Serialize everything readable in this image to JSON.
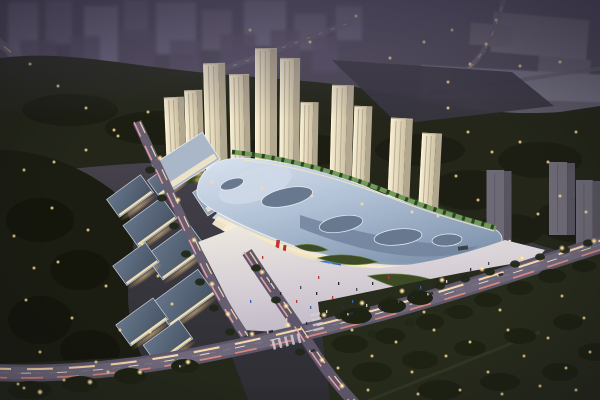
{
  "scene": {
    "type": "aerial-architectural-rendering",
    "time_of_day": "dusk",
    "subject": "mixed-use development: curved-roof shopping mall with front plaza, low-rise retail street, arc of lit residential towers, road intersection with light trails, surrounding parks and distant city",
    "landmarks": {
      "shopping_mall": "organic curved silver-blue roof with oval skylights and rooftop green walkway",
      "retail_street": "low-rise blocks with dark slate roofs and warm lit lanes, lower left",
      "residential_towers_lit": 11,
      "towers_unlit_gray": 3,
      "led_screen": "blue media screen on mall south facade",
      "roads": "main avenue lower area with headlight/taillight trails, cross street, upper-left diagonal road, winding upper-right road"
    },
    "lit_towers": [
      [
        177,
        97,
        170,
        20,
        -2.5
      ],
      [
        196,
        90,
        172,
        18,
        -2
      ],
      [
        217,
        63,
        176,
        22,
        -1.5
      ],
      [
        241,
        74,
        181,
        20,
        -1
      ],
      [
        266,
        48,
        186,
        22,
        0
      ],
      [
        289,
        58,
        190,
        20,
        0.5
      ],
      [
        308,
        102,
        194,
        18,
        1
      ],
      [
        340,
        85,
        200,
        22,
        1.5
      ],
      [
        360,
        106,
        203,
        18,
        2
      ],
      [
        398,
        118,
        208,
        22,
        2.5
      ],
      [
        428,
        133,
        212,
        20,
        3
      ]
    ],
    "unlit_towers": [
      [
        499,
        170,
        250,
        25
      ],
      [
        562,
        162,
        235,
        26
      ],
      [
        588,
        180,
        248,
        24
      ]
    ],
    "led_screen": {
      "x": 314,
      "y": 259,
      "w": 27,
      "h": 18
    },
    "banner_count": 2
  },
  "palette": {
    "sky_top": "#514b5e",
    "sky_mid": "#45414e",
    "ground_low": "#2e2d33",
    "distant_a": "#6f6980",
    "distant_b": "#585166",
    "warehouse": "#6e6876",
    "dark_lot": "#38353f",
    "trees_far": "#232619",
    "trees_near": "#1b1d12",
    "tree_clump": "#1d2213",
    "lawn": "#272b1b",
    "tower_face": "#e9ddc1",
    "tower_side": "#b2a78f",
    "tower_stripe": "#8a7f6a",
    "gray_tower": "#716d79",
    "gray_tower_side": "#5b5763",
    "podium_green": "#33401f",
    "podium_green_lit": "#93a352",
    "mall_roof": "#aebfd4",
    "mall_roof_light": "#dae3ef",
    "mall_roof_dark": "#8094ae",
    "mall_pool": "#72849d",
    "skylight": "#68788f",
    "green_walk": "#6f9a58",
    "facade_lit": "#f4ead2",
    "retail_roof": "#4b5869",
    "retail_roof_hi": "#66758a",
    "retail_trim": "#dfe3ea",
    "retail_lit_edge": "#f6e6bb",
    "plaza_bright": "#ece6de",
    "plaza": "#c6bfca",
    "road": "#5e5769",
    "road_inner": "#6f687a",
    "trail_warm": "#ffdfae",
    "trail_red": "#e8897a",
    "trail_pink": "#efa3ad",
    "light_dot": "#ffd98e",
    "screen_blue": "#2e6fe0",
    "screen_hi": "#9cc4ff",
    "banner_red": "#c23436",
    "people_colors": [
      "#2e2e38",
      "#4a4a54",
      "#23272e",
      "#b23c36",
      "#3c62a8",
      "#d8d3c8"
    ]
  }
}
